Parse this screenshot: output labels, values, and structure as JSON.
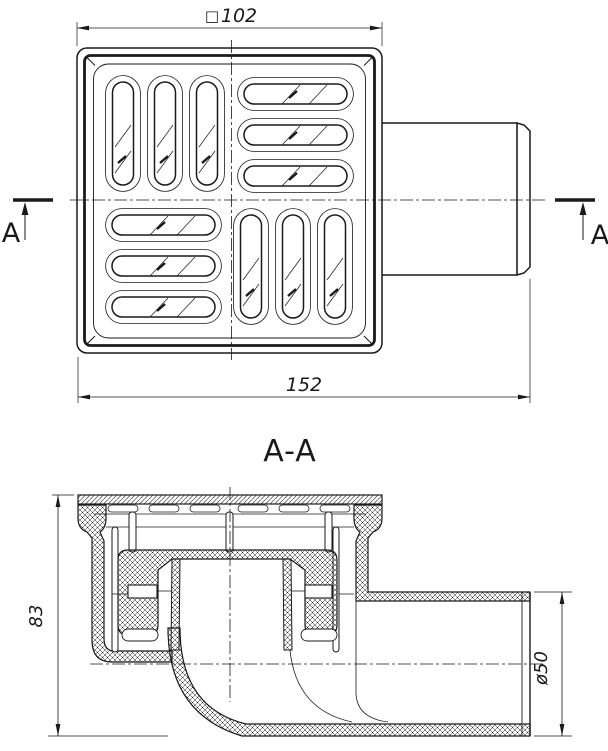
{
  "colors": {
    "line": "#1a1a1a",
    "background": "#ffffff"
  },
  "plan_view": {
    "square_dim_symbol": "□",
    "square_dim_value": "102",
    "overall_width_dim": "152",
    "cut_label_left": "A",
    "cut_label_right": "A"
  },
  "section_view": {
    "title": "A-A",
    "height_dim": "83",
    "outlet_diameter_dim": "ø50"
  }
}
